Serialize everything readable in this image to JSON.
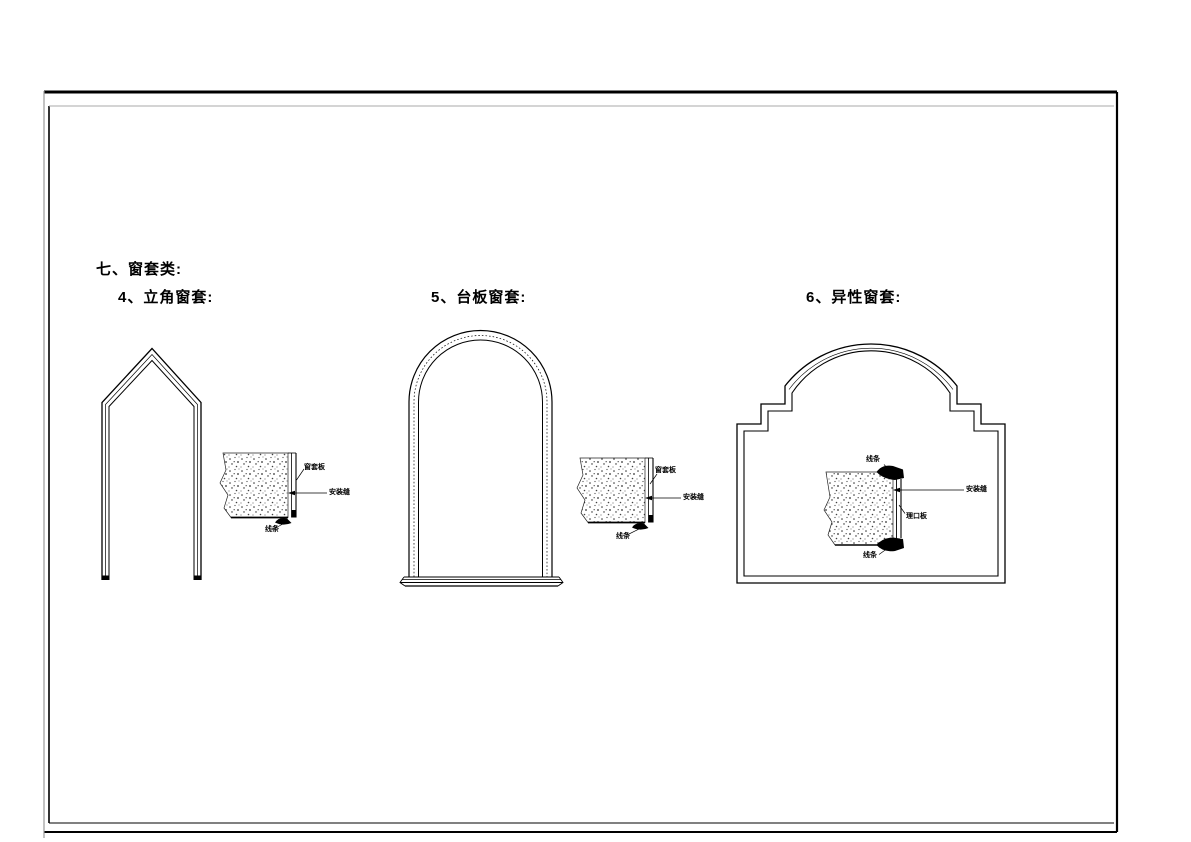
{
  "sheet": {
    "headings": {
      "section": "七、窗套类:",
      "item4": "4、立角窗套:",
      "item5": "5、台板窗套:",
      "item6": "6、异性窗套:"
    },
    "diagrams": {
      "d1": {
        "title": "立角窗套",
        "labels": {
          "board": "窗套板",
          "seam": "安装缝",
          "moulding": "线条"
        }
      },
      "d2": {
        "title": "台板窗套",
        "labels": {
          "board": "窗套板",
          "seam": "安装缝",
          "moulding": "线条"
        }
      },
      "d3": {
        "title": "异性窗套",
        "labels": {
          "moulding_top": "线条",
          "seam": "安装缝",
          "board": "理口板",
          "moulding_bottom": "线条"
        }
      }
    },
    "colors": {
      "line": "#000000",
      "frame_left": "#9a9a9a",
      "paper": "#ffffff"
    }
  }
}
